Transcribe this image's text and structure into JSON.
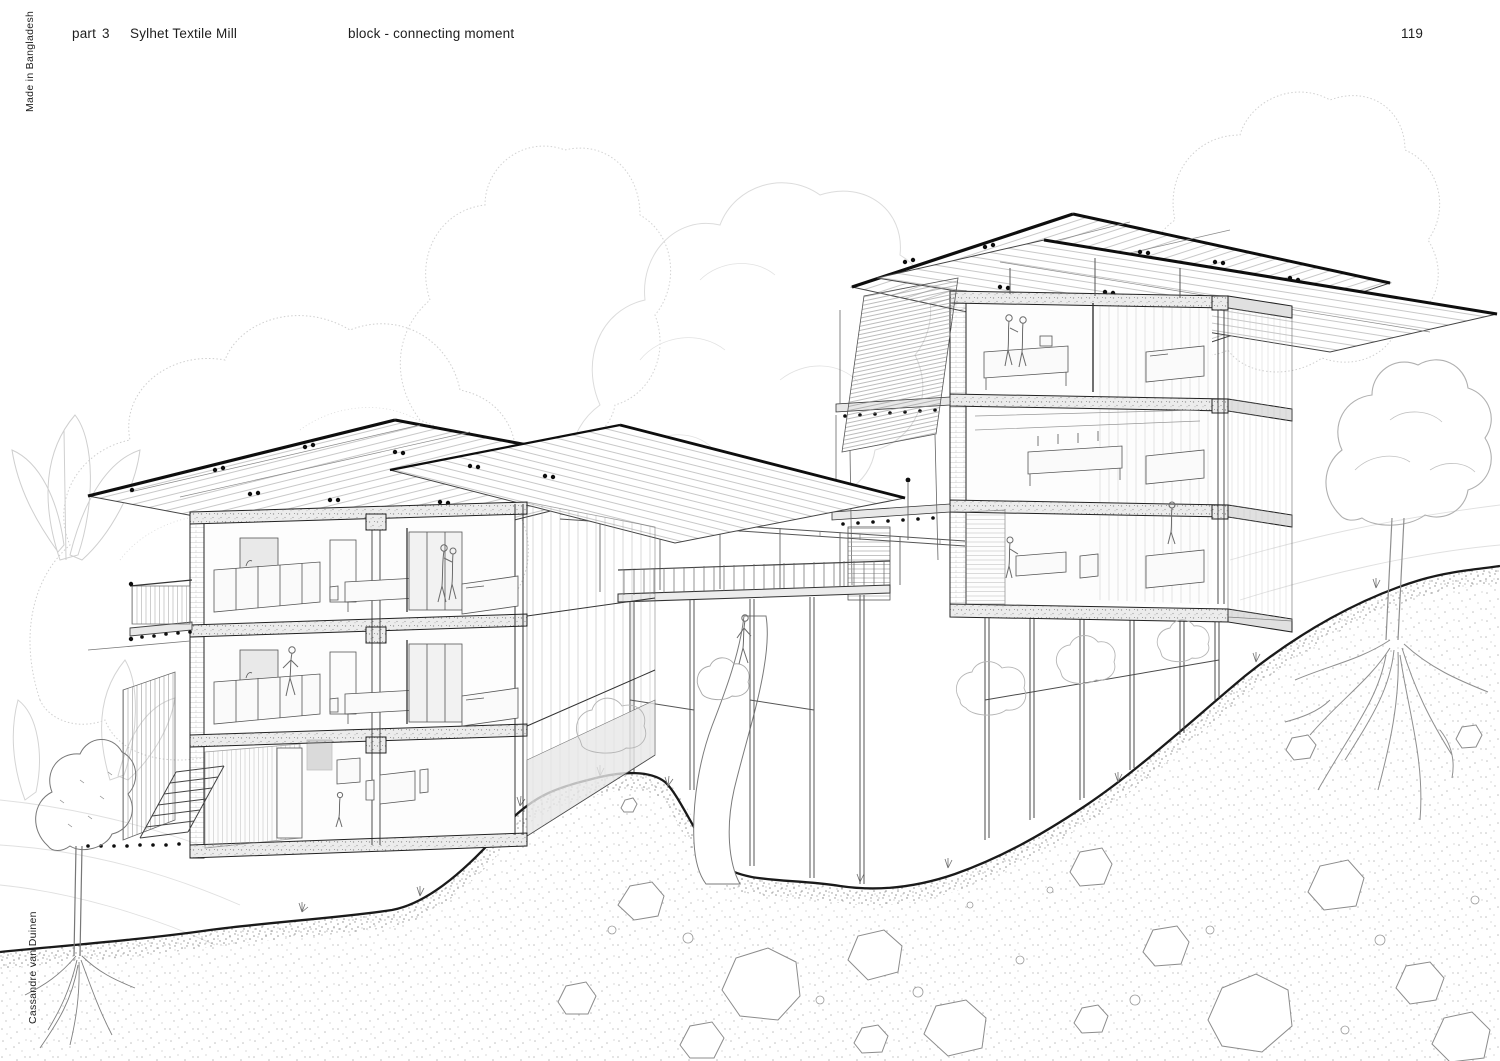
{
  "colors": {
    "paper": "#ffffff",
    "ink": "#1d1d1d",
    "sketch_light": "#cfcfcf",
    "concrete_speckle": "#ececec"
  },
  "header": {
    "part_label": "part",
    "part_number": "3",
    "project_title": "Sylhet Textile Mill",
    "drawing_title": "block - connecting moment",
    "page_number": "119"
  },
  "margins": {
    "left_top_vertical_text": "Made in Bangladesh",
    "left_bottom_vertical_text": "Cassandre van Duinen"
  },
  "drawing": {
    "alt": "Sectional perspective line drawing: two three-storey blocks with wide overhanging roofs connected by an elevated walkway over a sloping stippled hillside with rocks, trees and exposed roots"
  }
}
